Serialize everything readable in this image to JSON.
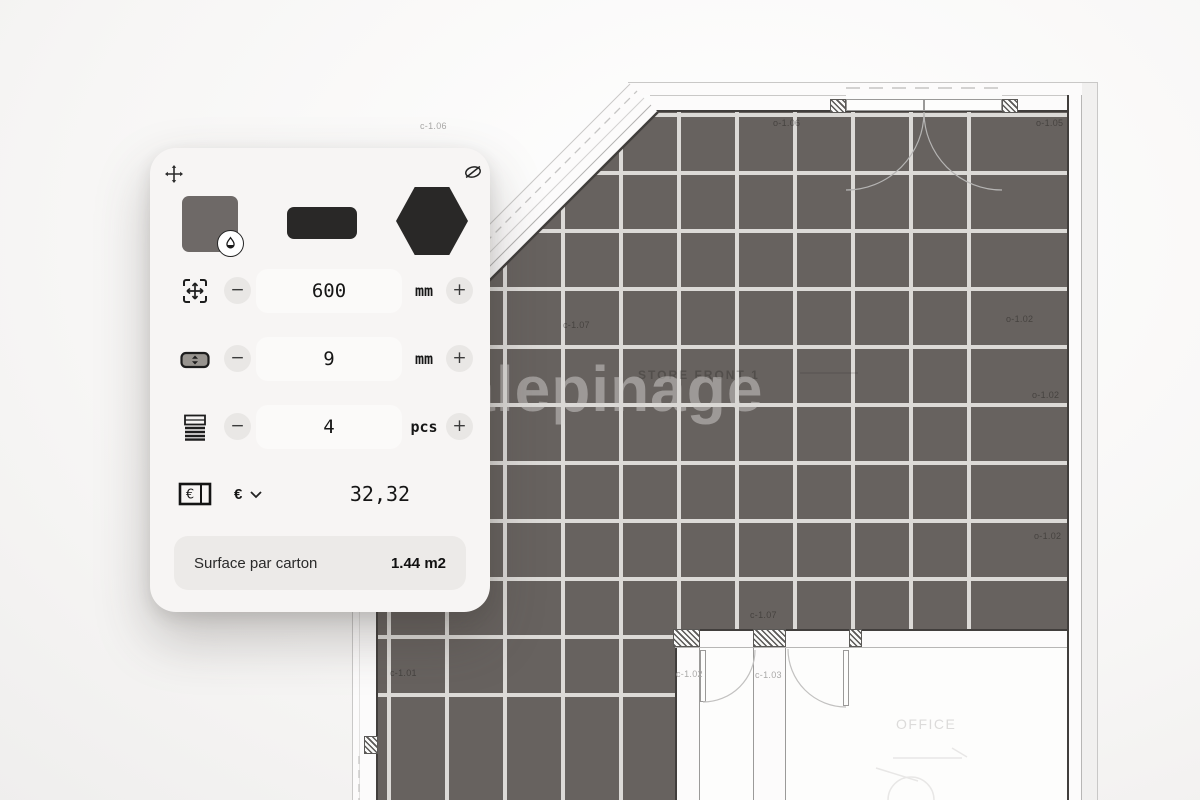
{
  "panel": {
    "icons": {
      "move": "arrows-move",
      "hide": "slashed-circle",
      "color_picker": "droplet",
      "size": "scale-frame",
      "joint": "joint-width-pill",
      "pieces": "stacked-sheets",
      "price": "banknote",
      "currency_dropdown": "chevron-down"
    },
    "swatch_color": "#6e6967",
    "shape_color": "#292827",
    "controls": {
      "decrease": "−",
      "increase": "+"
    },
    "rows": {
      "size": {
        "value": "600",
        "unit": "mm"
      },
      "joint": {
        "value": "9",
        "unit": "mm"
      },
      "pieces": {
        "value": "4",
        "unit": "pcs"
      },
      "price": {
        "currency": "€",
        "value": "32,32"
      }
    },
    "summary": {
      "label": "Surface par carton",
      "value": "1.44 m2"
    }
  },
  "plan": {
    "watermark": "Calepinage",
    "tile_color": "#67625f",
    "joint_color": "#dcdad7",
    "rooms": [
      {
        "text": "STORE FRONT 1",
        "x": 638,
        "y": 368,
        "tone": "room-dark"
      },
      {
        "text": "OFFICE",
        "x": 896,
        "y": 716,
        "tone": "room-light"
      }
    ],
    "annotations": [
      {
        "text": "c-1.06",
        "x": 420,
        "y": 121,
        "tone": "on-white"
      },
      {
        "text": "o-1.06",
        "x": 773,
        "y": 118,
        "tone": "on-tile"
      },
      {
        "text": "o-1.05",
        "x": 1036,
        "y": 118,
        "tone": "on-tile"
      },
      {
        "text": "c-1.07",
        "x": 563,
        "y": 320,
        "tone": "on-tile"
      },
      {
        "text": "o-1.02",
        "x": 1006,
        "y": 314,
        "tone": "on-tile"
      },
      {
        "text": "o-1.02",
        "x": 1032,
        "y": 390,
        "tone": "on-tile"
      },
      {
        "text": "o-1.02",
        "x": 1034,
        "y": 531,
        "tone": "on-tile"
      },
      {
        "text": "c-1.07",
        "x": 750,
        "y": 610,
        "tone": "on-tile"
      },
      {
        "text": "c-1.01",
        "x": 390,
        "y": 668,
        "tone": "on-tile"
      },
      {
        "text": "c-1.02",
        "x": 676,
        "y": 669,
        "tone": "on-white"
      },
      {
        "text": "c-1.03",
        "x": 755,
        "y": 670,
        "tone": "on-white"
      }
    ]
  }
}
